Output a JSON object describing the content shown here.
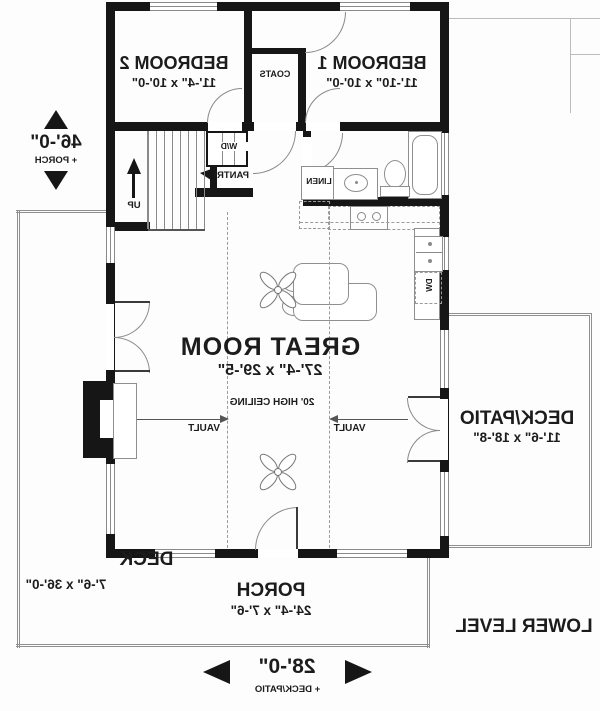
{
  "labels": {
    "bedroom1_name": "BEDROOM 1",
    "bedroom1_dims": "11'-10\" x 10'-0\"",
    "bedroom2_name": "BEDROOM 2",
    "bedroom2_dims": "11'-4\" x 10'-0\"",
    "coats": "COATS",
    "linen": "LINEN",
    "wd": "W/D",
    "dw": "DW",
    "pantry": "PANTRY",
    "up": "UP",
    "great_name": "GREAT ROOM",
    "great_dims": "27'-4\" x 29'-5\"",
    "ceiling": "20' HIGH CEILING",
    "vault": "VAULT",
    "deckpatio_name": "DECK/PATIO",
    "deckpatio_dims": "11'-6\" x 18'-8\"",
    "deck_name": "DECK",
    "deck_dims": "7'-6\" x 36'-0\"",
    "porch_name": "PORCH",
    "porch_dims": "24'-4\" x 7'-6\"",
    "lower_level": "LOWER LEVEL",
    "depth_value": "46'-0\"",
    "depth_note": "+ PORCH",
    "width_value": "28'-0\"",
    "width_note": "+ DECK/PATIO"
  },
  "colors": {
    "wall": "#161616",
    "fixture_line": "#8a8a8a",
    "text": "#1c1c1c",
    "background": "#fdfdfd"
  }
}
